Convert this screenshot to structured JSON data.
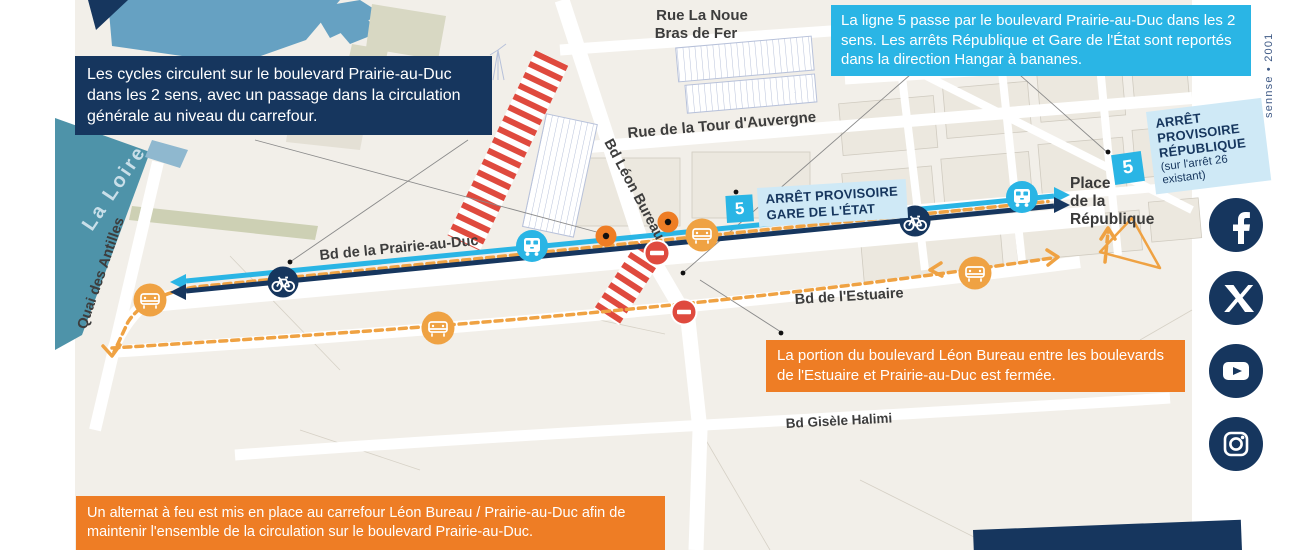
{
  "colors": {
    "navy": "#16365e",
    "cyan": "#2ab5e5",
    "orange": "#ee7d25",
    "amber": "#efa243",
    "red": "#df4a3e",
    "label_blue": "#cfe9f6",
    "map_bg": "#f2efe9",
    "water_dark": "#4e93a9",
    "water_light": "#66a1c2"
  },
  "callouts": {
    "cycles": "Les cycles circulent sur le boulevard Prairie-au-Duc dans les 2 sens, avec un passage dans la circulation générale au niveau du carrefour.",
    "line5": "La ligne 5 passe par le boulevard Prairie-au-Duc dans les 2 sens. Les arrêts République et Gare de l'État sont reportés dans la direction Hangar à bananes.",
    "leon_bureau": "La portion du boulevard Léon Bureau entre les boulevards de l'Estuaire et Prairie-au-Duc est fermée.",
    "alternat": "Un alternat à feu est mis en place au carrefour Léon Bureau / Prairie-au-Duc afin de maintenir l'ensemble de la circulation sur le boulevard Prairie-au-Duc."
  },
  "stops": {
    "gare_etat": {
      "badge": "5",
      "line1": "ARRÊT PROVISOIRE",
      "line2": "GARE DE L'ÉTAT"
    },
    "republique": {
      "badge": "5",
      "line1": "ARRÊT",
      "line2": "PROVISOIRE",
      "line3": "RÉPUBLIQUE",
      "note1": "(sur l'arrêt 26",
      "note2": "existant)"
    }
  },
  "streets": {
    "rue_la_noue_1": "Rue La Noue",
    "rue_la_noue_2": "Bras de Fer",
    "tour_auvergne": "Rue de la Tour d'Auvergne",
    "leon_bureau": "Bd Léon Bureau",
    "prairie_au_duc": "Bd de la Prairie-au-Duc",
    "estuaire": "Bd de l'Estuaire",
    "gisele_halimi": "Bd Gisèle Halimi",
    "quai_antilles": "Quai des Antilles"
  },
  "places": {
    "la_loire": "La Loire",
    "republique_1": "Place",
    "republique_2": "de la",
    "republique_3": "République"
  },
  "credit": "sennse • 2001",
  "social": [
    "facebook-icon",
    "x-icon",
    "youtube-icon",
    "instagram-icon"
  ]
}
